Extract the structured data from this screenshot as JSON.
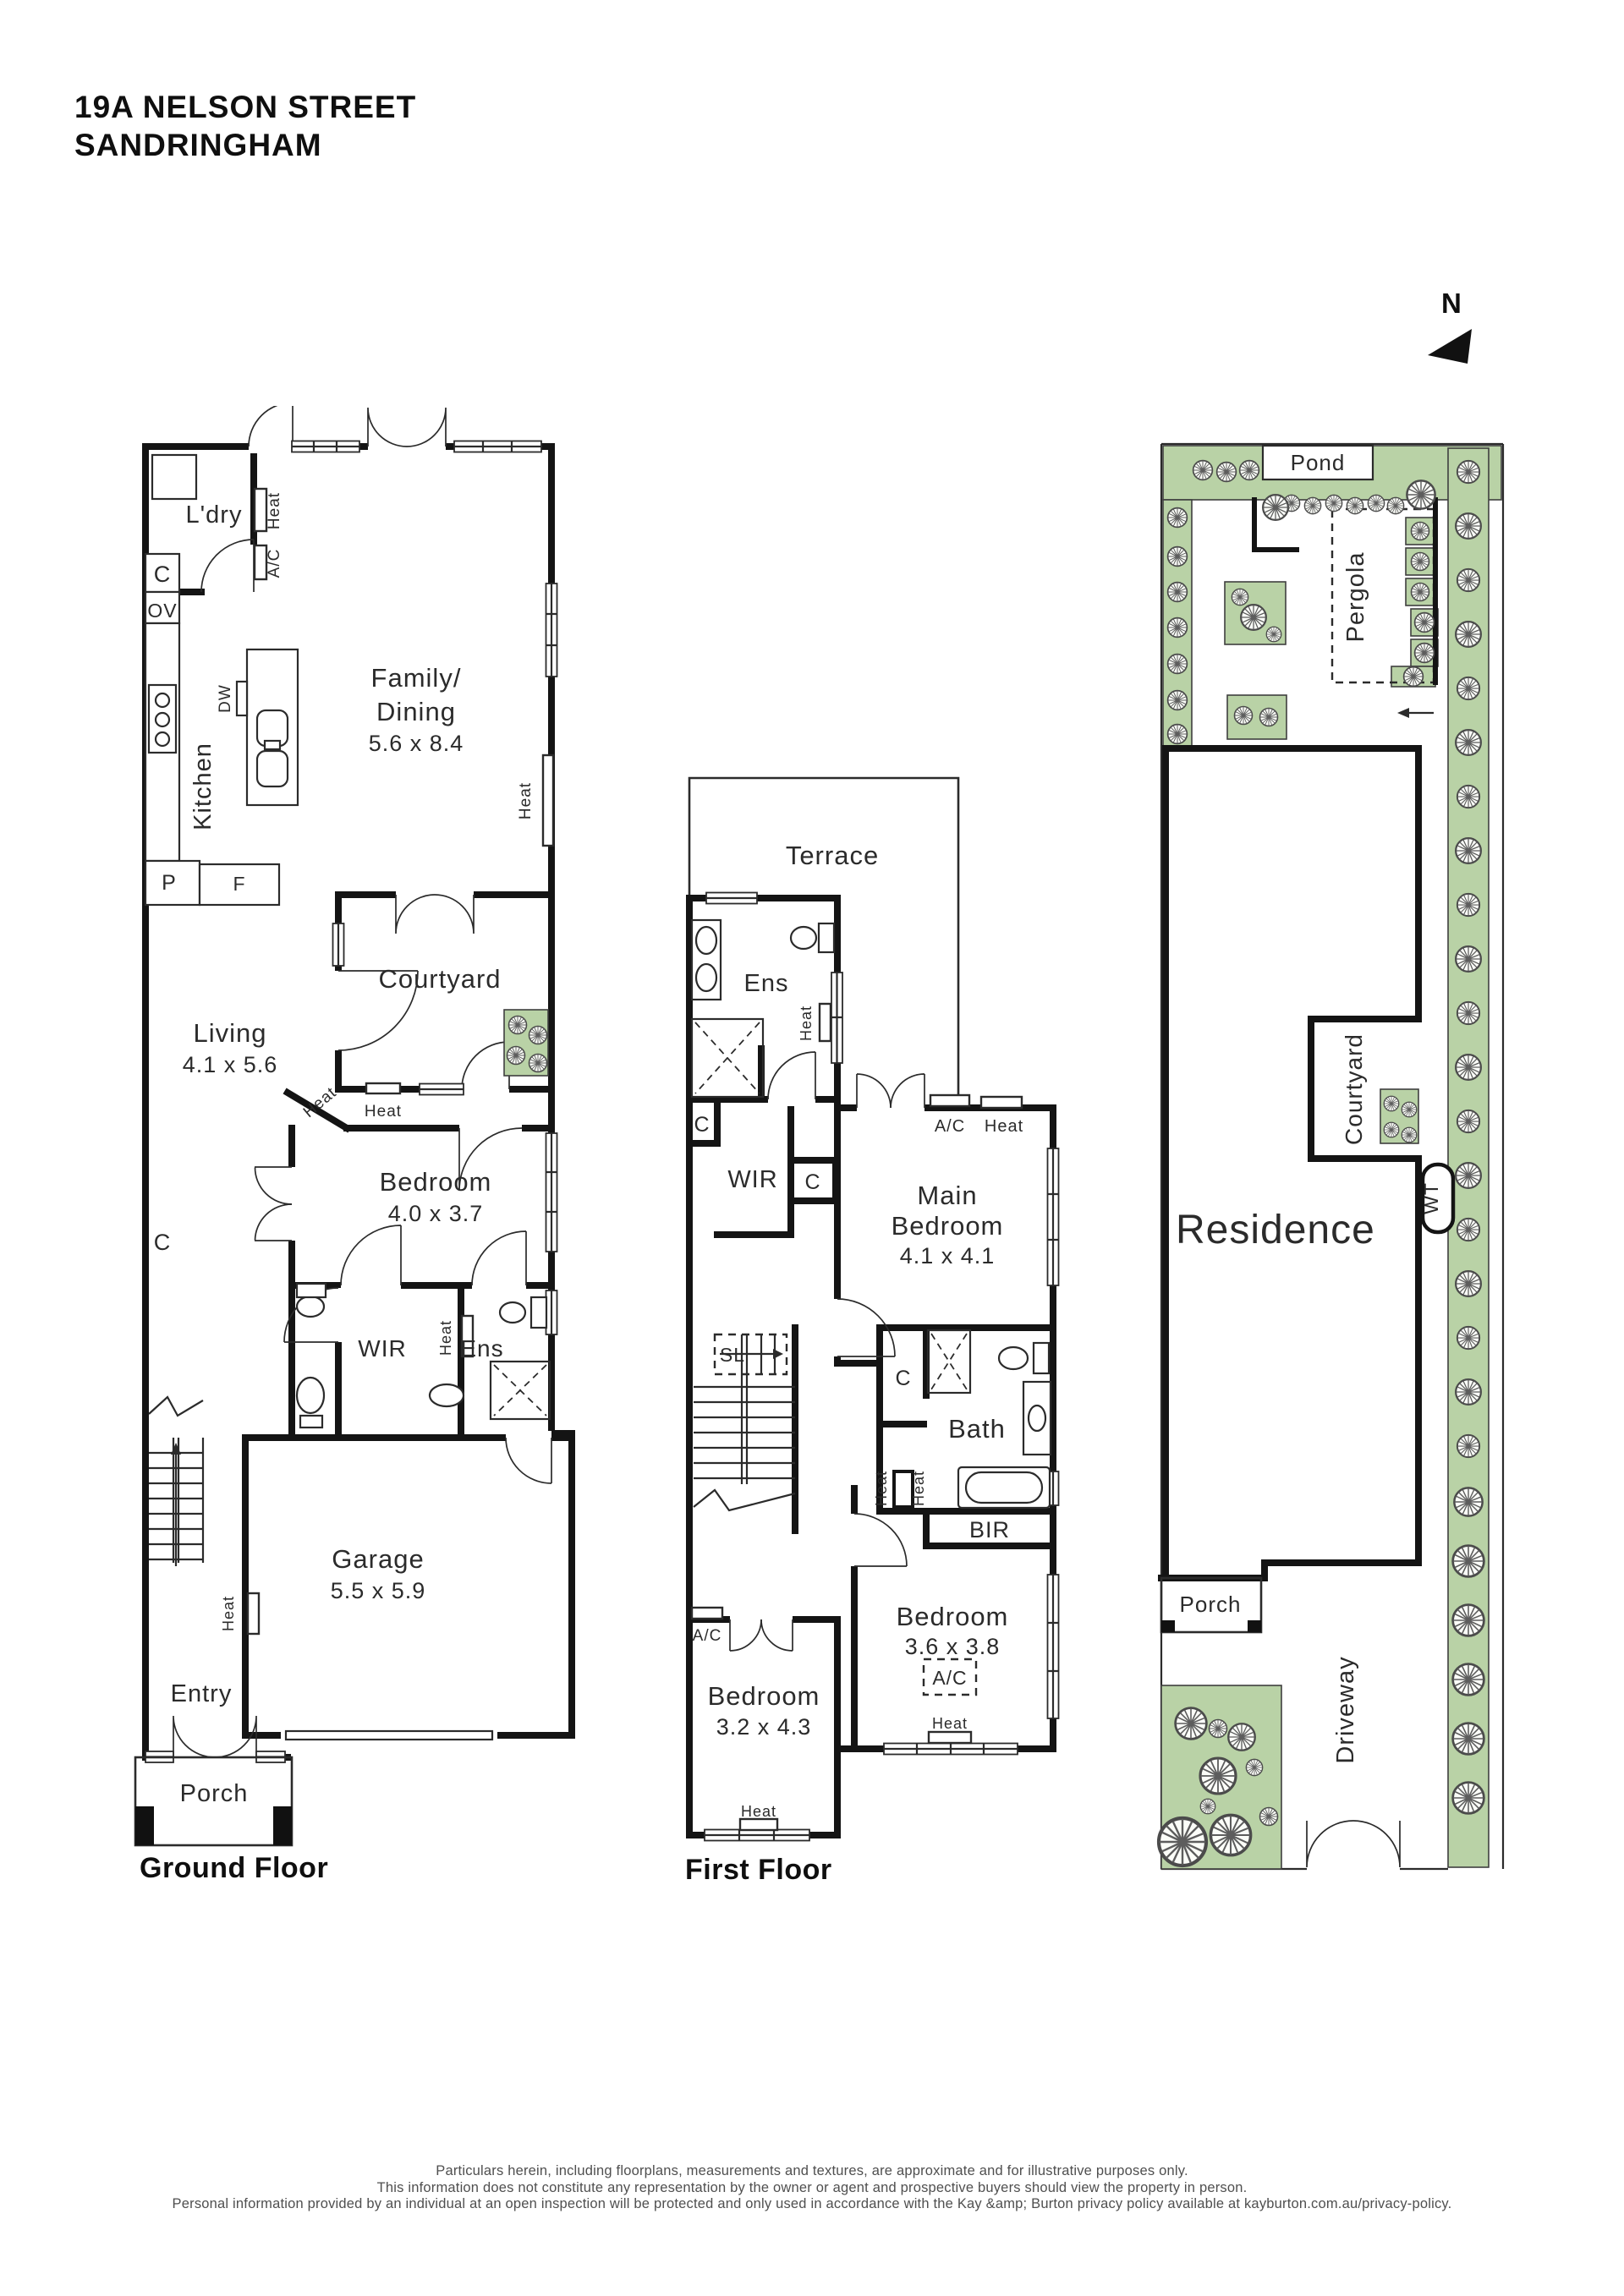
{
  "header": {
    "address_line1": "19A NELSON STREET",
    "address_line2": "SANDRINGHAM"
  },
  "north": {
    "label": "N"
  },
  "ground_floor": {
    "caption": "Ground Floor",
    "labels": {
      "laundry": "L'dry",
      "heat_laundry": "Heat",
      "ac_laundry": "A/C",
      "cupboard": "C",
      "oven": "OV",
      "kitchen": "Kitchen",
      "dishwasher": "DW",
      "pantry": "P",
      "fridge": "F",
      "family_dining_line1": "Family/",
      "family_dining_line2": "Dining",
      "family_dining_dims": "5.6 x 8.4",
      "heat_family": "Heat",
      "living": "Living",
      "living_dims": "4.1 x 5.6",
      "courtyard": "Courtyard",
      "heat_living_diag": "Heat",
      "heat_living": "Heat",
      "bedroom": "Bedroom",
      "bedroom_dims": "4.0 x 3.7",
      "cupboard_hall": "C",
      "wir": "WIR",
      "ens": "Ens",
      "heat_ens": "Heat",
      "garage": "Garage",
      "garage_dims": "5.5 x 5.9",
      "heat_garage": "Heat",
      "entry": "Entry",
      "porch": "Porch"
    }
  },
  "first_floor": {
    "caption": "First Floor",
    "labels": {
      "terrace": "Terrace",
      "ens": "Ens",
      "heat_ens": "Heat",
      "cupboard_landing": "C",
      "wir": "WIR",
      "cupboard_wir": "C",
      "main_bedroom_line1": "Main",
      "main_bedroom_line2": "Bedroom",
      "main_bedroom_dims": "4.1 x 4.1",
      "ac_main": "A/C",
      "heat_main": "Heat",
      "skylight": "SL",
      "cupboard_bath": "C",
      "bath": "Bath",
      "heat_hall": "Heat",
      "heat_bath": "Heat",
      "bir": "BIR",
      "bedroom2": "Bedroom",
      "bedroom2_dims": "3.6 x 3.8",
      "ac_bedroom2": "A/C",
      "heat_bedroom2": "Heat",
      "bedroom3": "Bedroom",
      "bedroom3_dims": "3.2 x 4.3",
      "ac_bedroom3": "A/C",
      "heat_bedroom3": "Heat"
    }
  },
  "site_plan": {
    "labels": {
      "pond": "Pond",
      "pergola": "Pergola",
      "courtyard": "Courtyard",
      "water_tank": "WT",
      "residence": "Residence",
      "porch": "Porch",
      "driveway": "Driveway"
    }
  },
  "footer": {
    "line1": "Particulars herein, including floorplans, measurements and textures, are approximate and for illustrative purposes only.",
    "line2": "This information does not constitute any representation by the owner or agent and prospective buyers should view the property in person.",
    "line3": "Personal information provided by an individual at an open inspection will be protected and only used in accordance with the Kay &amp; Burton privacy policy available at kayburton.com.au/privacy-policy."
  },
  "colors": {
    "wall": "#141414",
    "garden": "#b9d2a6",
    "text": "#2b2b2b",
    "footer_text": "#4f4f4f"
  }
}
